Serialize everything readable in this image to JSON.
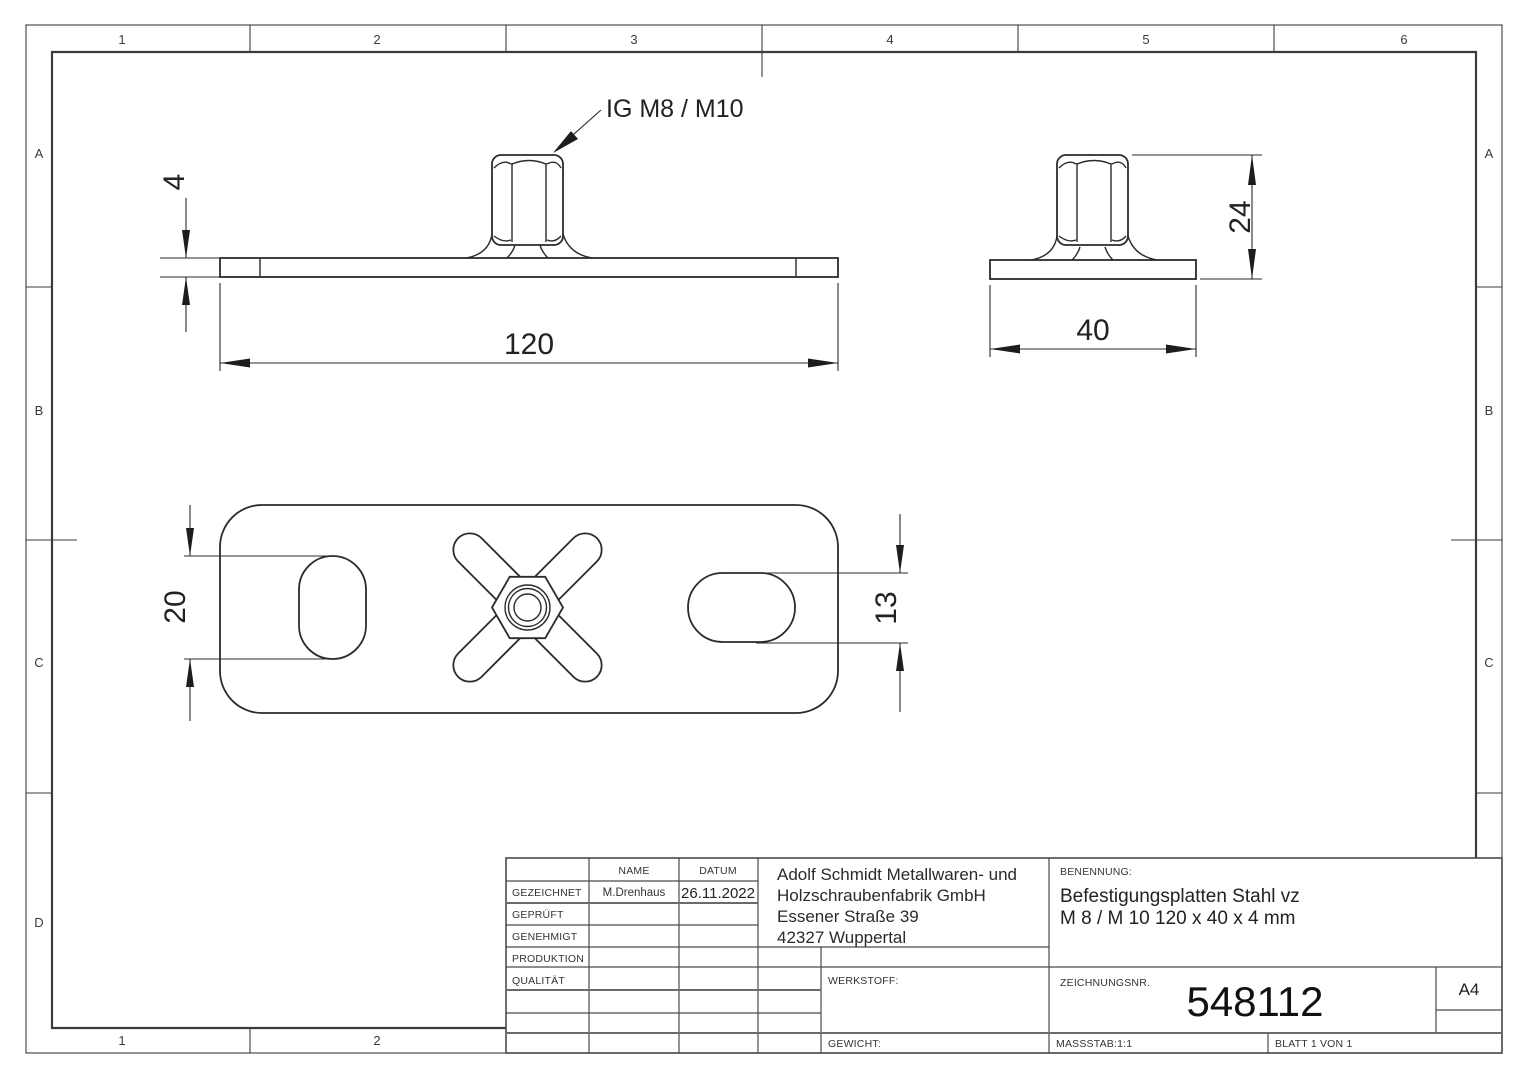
{
  "zones": {
    "top": [
      "1",
      "2",
      "3",
      "4",
      "5",
      "6"
    ],
    "bottom": [
      "1",
      "2"
    ],
    "left": [
      "A",
      "B",
      "C",
      "D"
    ],
    "right": [
      "A",
      "B",
      "C"
    ]
  },
  "dims": {
    "plate_length": "120",
    "plate_width": "40",
    "thickness": "4",
    "total_height": "24",
    "slot_length": "20",
    "slot_width": "13"
  },
  "callout": "IG M8 / M10",
  "title_block": {
    "header": {
      "name": "NAME",
      "datum": "DATUM"
    },
    "rows": {
      "gezeichnet": {
        "label": "GEZEICHNET",
        "name": "M.Drenhaus",
        "date": "26.11.2022"
      },
      "geprueft": {
        "label": "GEPRÜFT"
      },
      "genehmigt": {
        "label": "GENEHMIGT"
      },
      "produktion": {
        "label": "PRODUKTION"
      },
      "qualitaet": {
        "label": "QUALITÄT"
      }
    },
    "company": {
      "line1": "Adolf Schmidt Metallwaren- und",
      "line2": "Holzschraubenfabrik GmbH",
      "line3": "Essener Straße 39",
      "line4": "42327 Wuppertal"
    },
    "benennung_label": "BENENNUNG:",
    "title_line1": "Befestigungsplatten Stahl vz",
    "title_line2": "M 8 / M 10   120 x 40 x 4 mm",
    "werkstoff_label": "WERKSTOFF:",
    "gewicht_label": "GEWICHT:",
    "zeichnungsnr_label": "ZEICHNUNGSNR.",
    "drawing_number": "548112",
    "format": "A4",
    "massstab": "MASSSTAB:1:1",
    "blatt": "BLATT 1 VON 1"
  }
}
